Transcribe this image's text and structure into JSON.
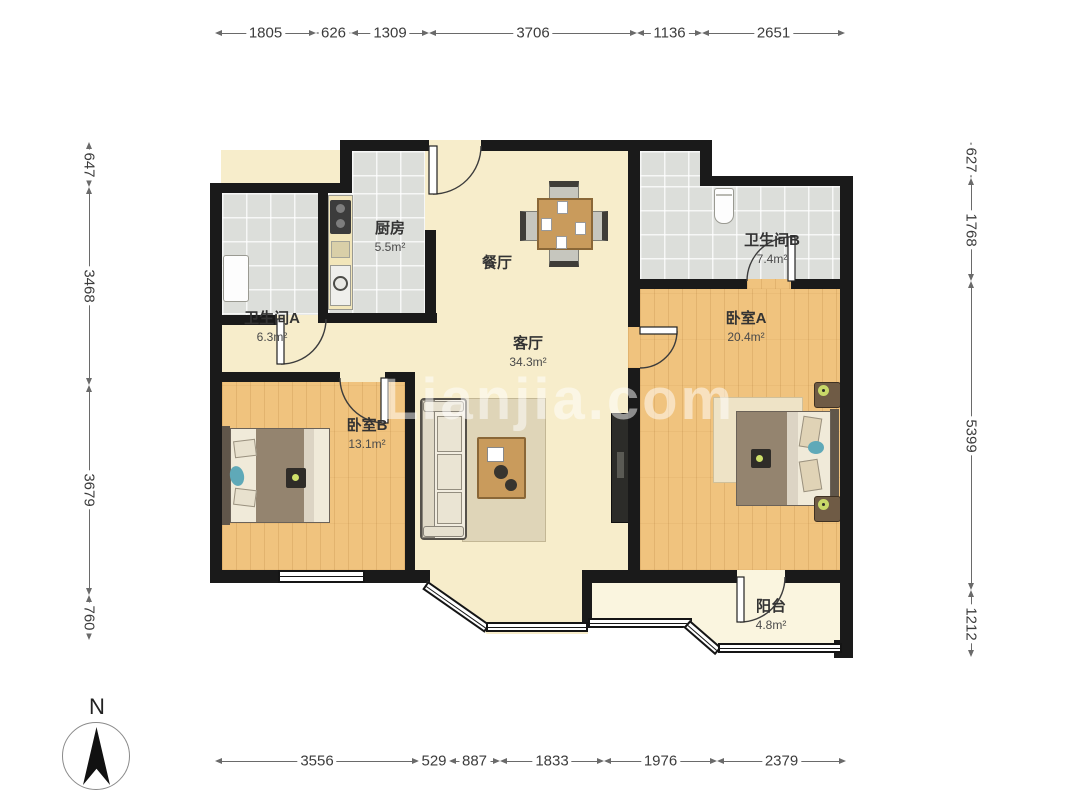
{
  "rooms": {
    "kitchen": {
      "name": "厨房",
      "area": "5.5m²"
    },
    "bathroom_a": {
      "name": "卫生间A",
      "area": "6.3m²"
    },
    "bathroom_b": {
      "name": "卫生间B",
      "area": "7.4m²"
    },
    "dining": {
      "name": "餐厅",
      "area": ""
    },
    "living": {
      "name": "客厅",
      "area": "34.3m²"
    },
    "bedroom_a": {
      "name": "卧室A",
      "area": "20.4m²"
    },
    "bedroom_b": {
      "name": "卧室B",
      "area": "13.1m²"
    },
    "balcony": {
      "name": "阳台",
      "area": "4.8m²"
    }
  },
  "dimensions": {
    "top": [
      "1805",
      "626",
      "1309",
      "3706",
      "1136",
      "2651"
    ],
    "left": [
      "647",
      "3468",
      "3679",
      "760"
    ],
    "right": [
      "627",
      "1768",
      "5399",
      "1212"
    ],
    "bottom": [
      "3556",
      "529",
      "887",
      "1833",
      "1976",
      "2379"
    ]
  },
  "compass": {
    "label": "N"
  },
  "watermark": "Lianjia.com",
  "colors": {
    "wall": "#1a1a1a",
    "wood_floor": "#f0c37e",
    "tile_floor": "#dcdeda",
    "living_floor": "#f7edcb",
    "balcony_floor": "#faf5df"
  }
}
